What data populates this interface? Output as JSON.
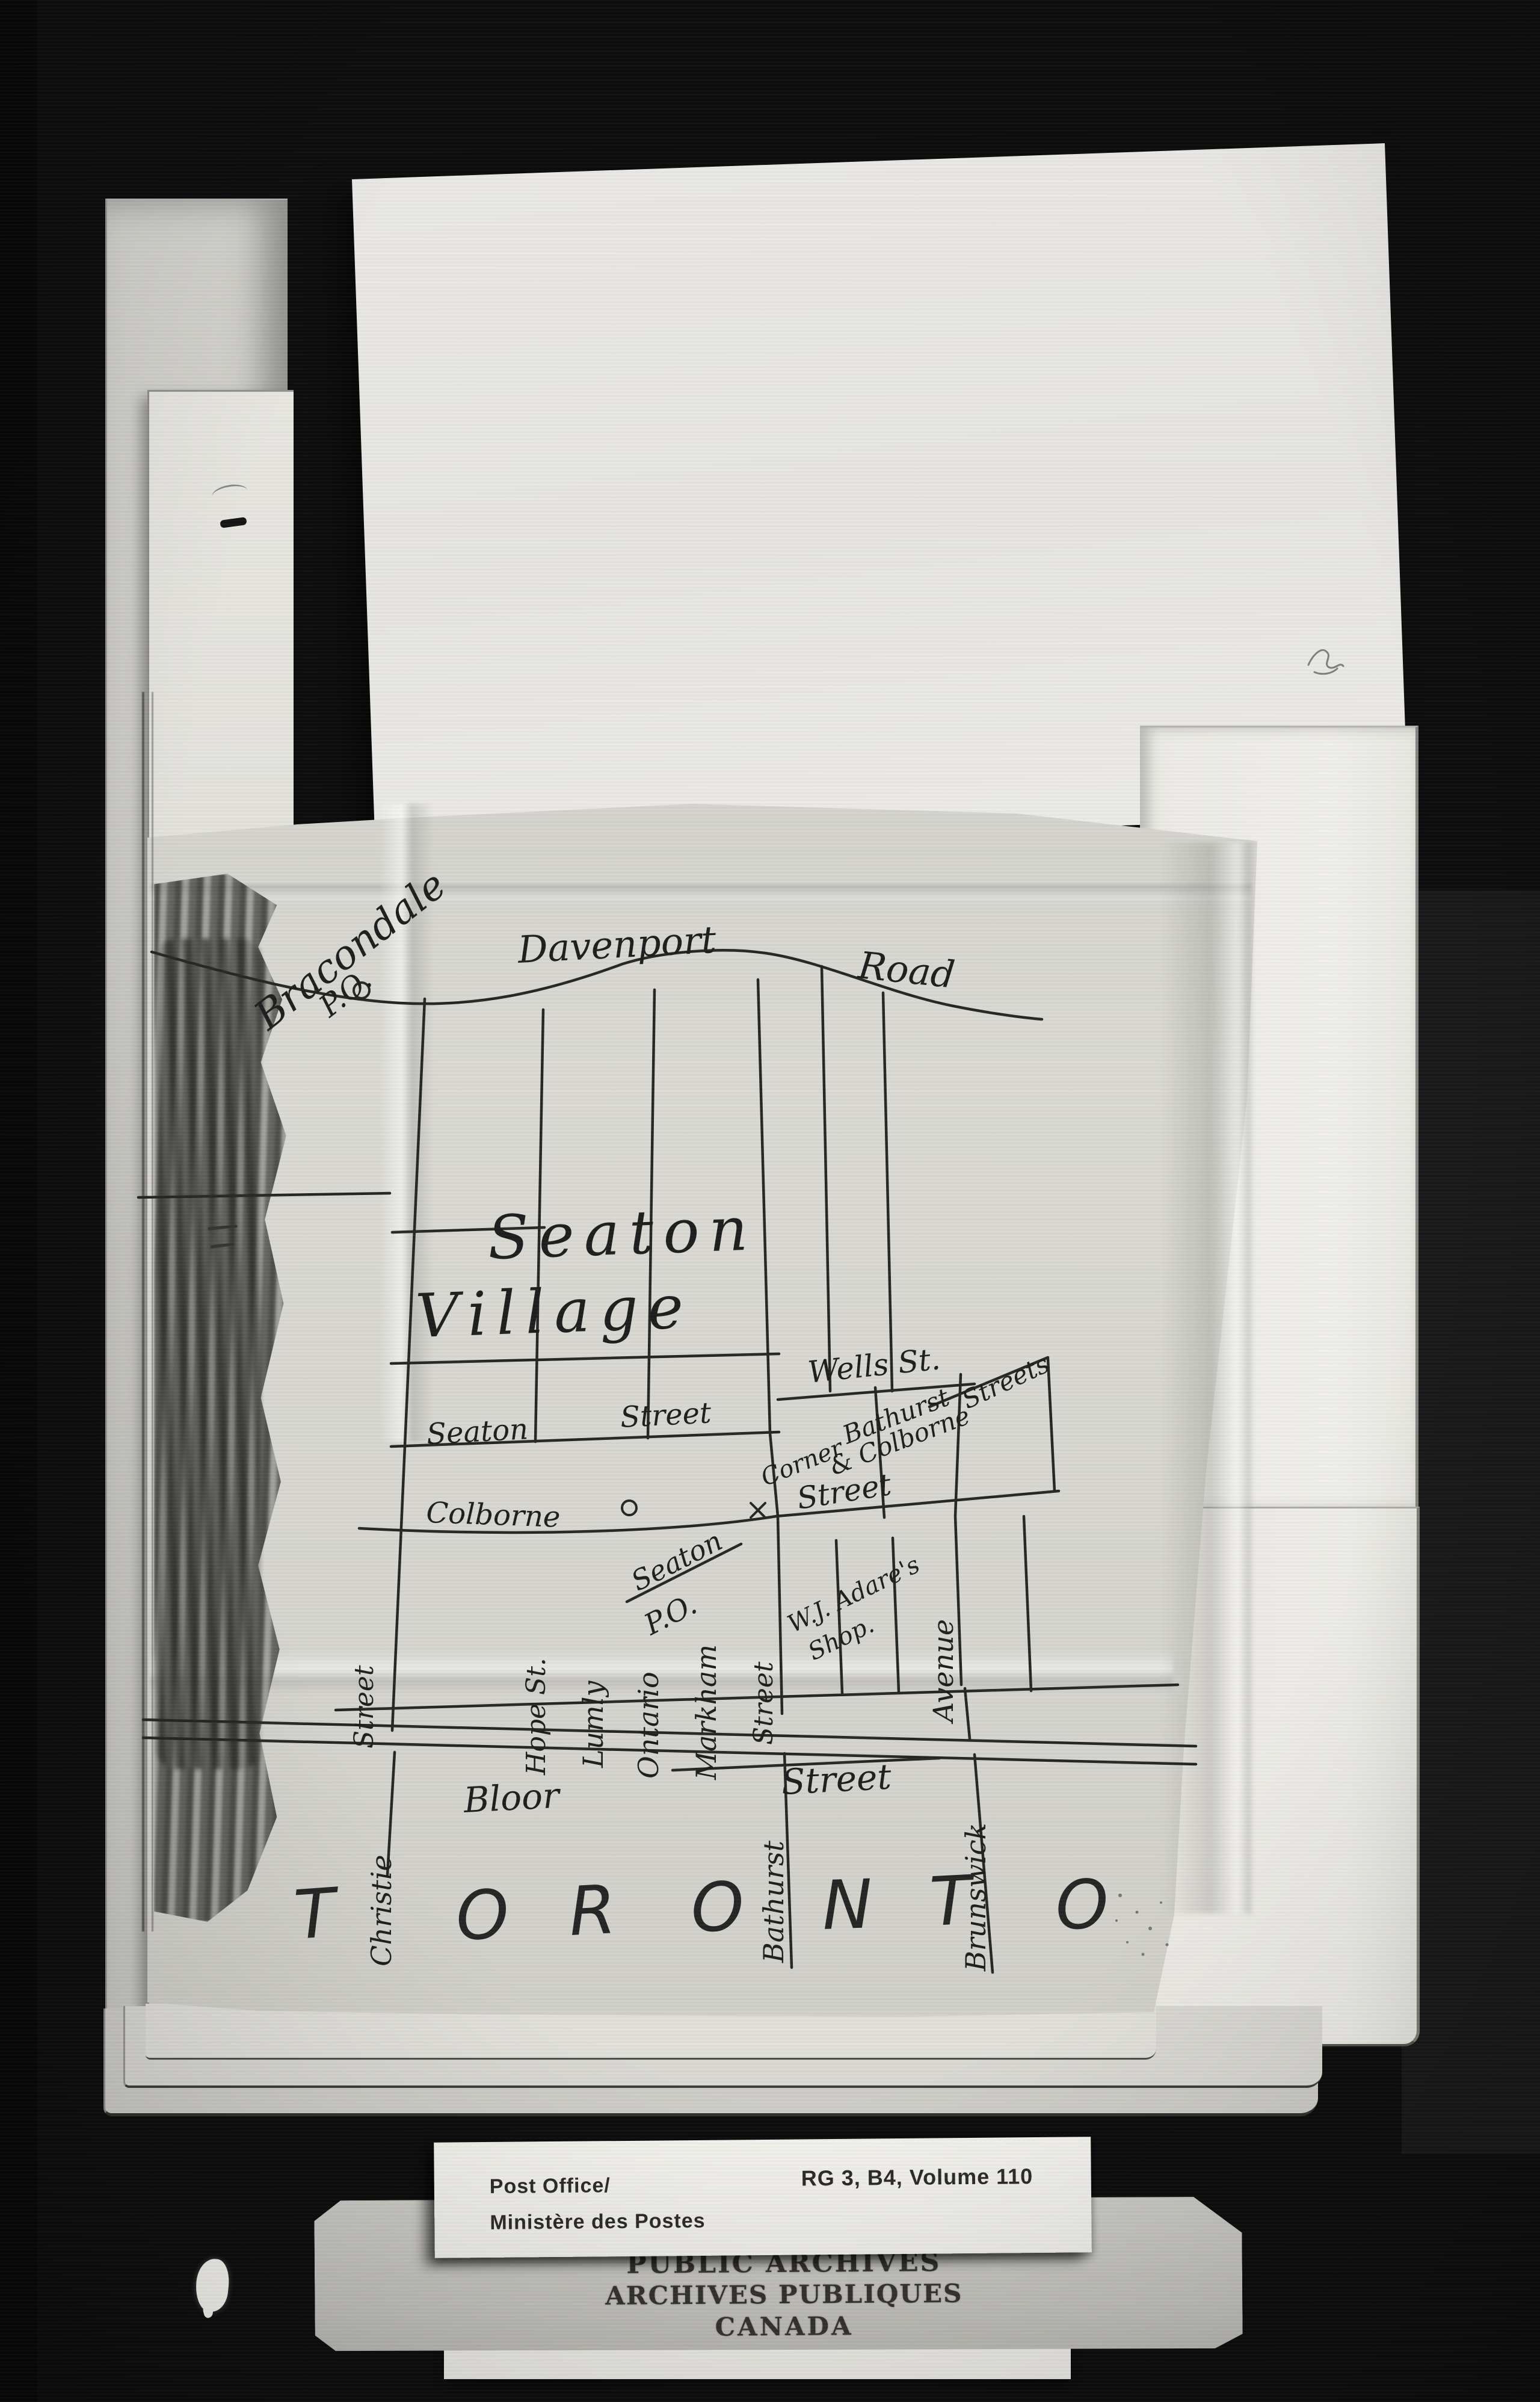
{
  "map": {
    "po_top": {
      "name": "Bracondale",
      "po": "P.O."
    },
    "roads": {
      "davenport": "Davenport",
      "road": "Road",
      "wells": "Wells St.",
      "seaton": "Seaton",
      "seaton_street_word": "Street",
      "colborne": "Colborne",
      "colborne_street_word": "Street",
      "bloor": "Bloor",
      "bloor_street_word": "Street"
    },
    "settlement": {
      "line1": "Seaton",
      "line2": "Village"
    },
    "po_corner": {
      "name": "Seaton",
      "po": "P.O."
    },
    "corner_note": {
      "full": "Corner Bathurst & Colborne Streets",
      "part1": "Corner",
      "part2": "Bathurst",
      "part3": "& Colborne",
      "part4": "Streets"
    },
    "shop_note": {
      "line1": "W.J. Adare's",
      "line2": "Shop."
    },
    "vertical_streets": {
      "christie_word": "Street",
      "christie": "Christie",
      "hope": "Hope St.",
      "lumly": "Lumly",
      "ontario": "Ontario",
      "markham": "Markham",
      "bathurst_word": "Street",
      "bathurst": "Bathurst",
      "avenue": "Avenue",
      "brunswick": "Brunswick"
    },
    "city": {
      "name": "TORONTO",
      "letters": [
        "T",
        "O",
        "R",
        "O",
        "N",
        "T",
        "O"
      ]
    }
  },
  "archive_label": {
    "dept_en": "Post Office/",
    "dept_fr": "Ministère des Postes",
    "reference": "RG 3, B4, Volume 110"
  },
  "archive_stamp": {
    "line1": "PUBLIC ARCHIVES",
    "line2": "ARCHIVES PUBLIQUES",
    "line3": "CANADA"
  },
  "colors": {
    "background": "#0d0d0d",
    "paper_white": "#eae9e5",
    "tracing_paper": "#d8d7d1",
    "ink": "#262624",
    "stamp_ink": "#34322e"
  }
}
